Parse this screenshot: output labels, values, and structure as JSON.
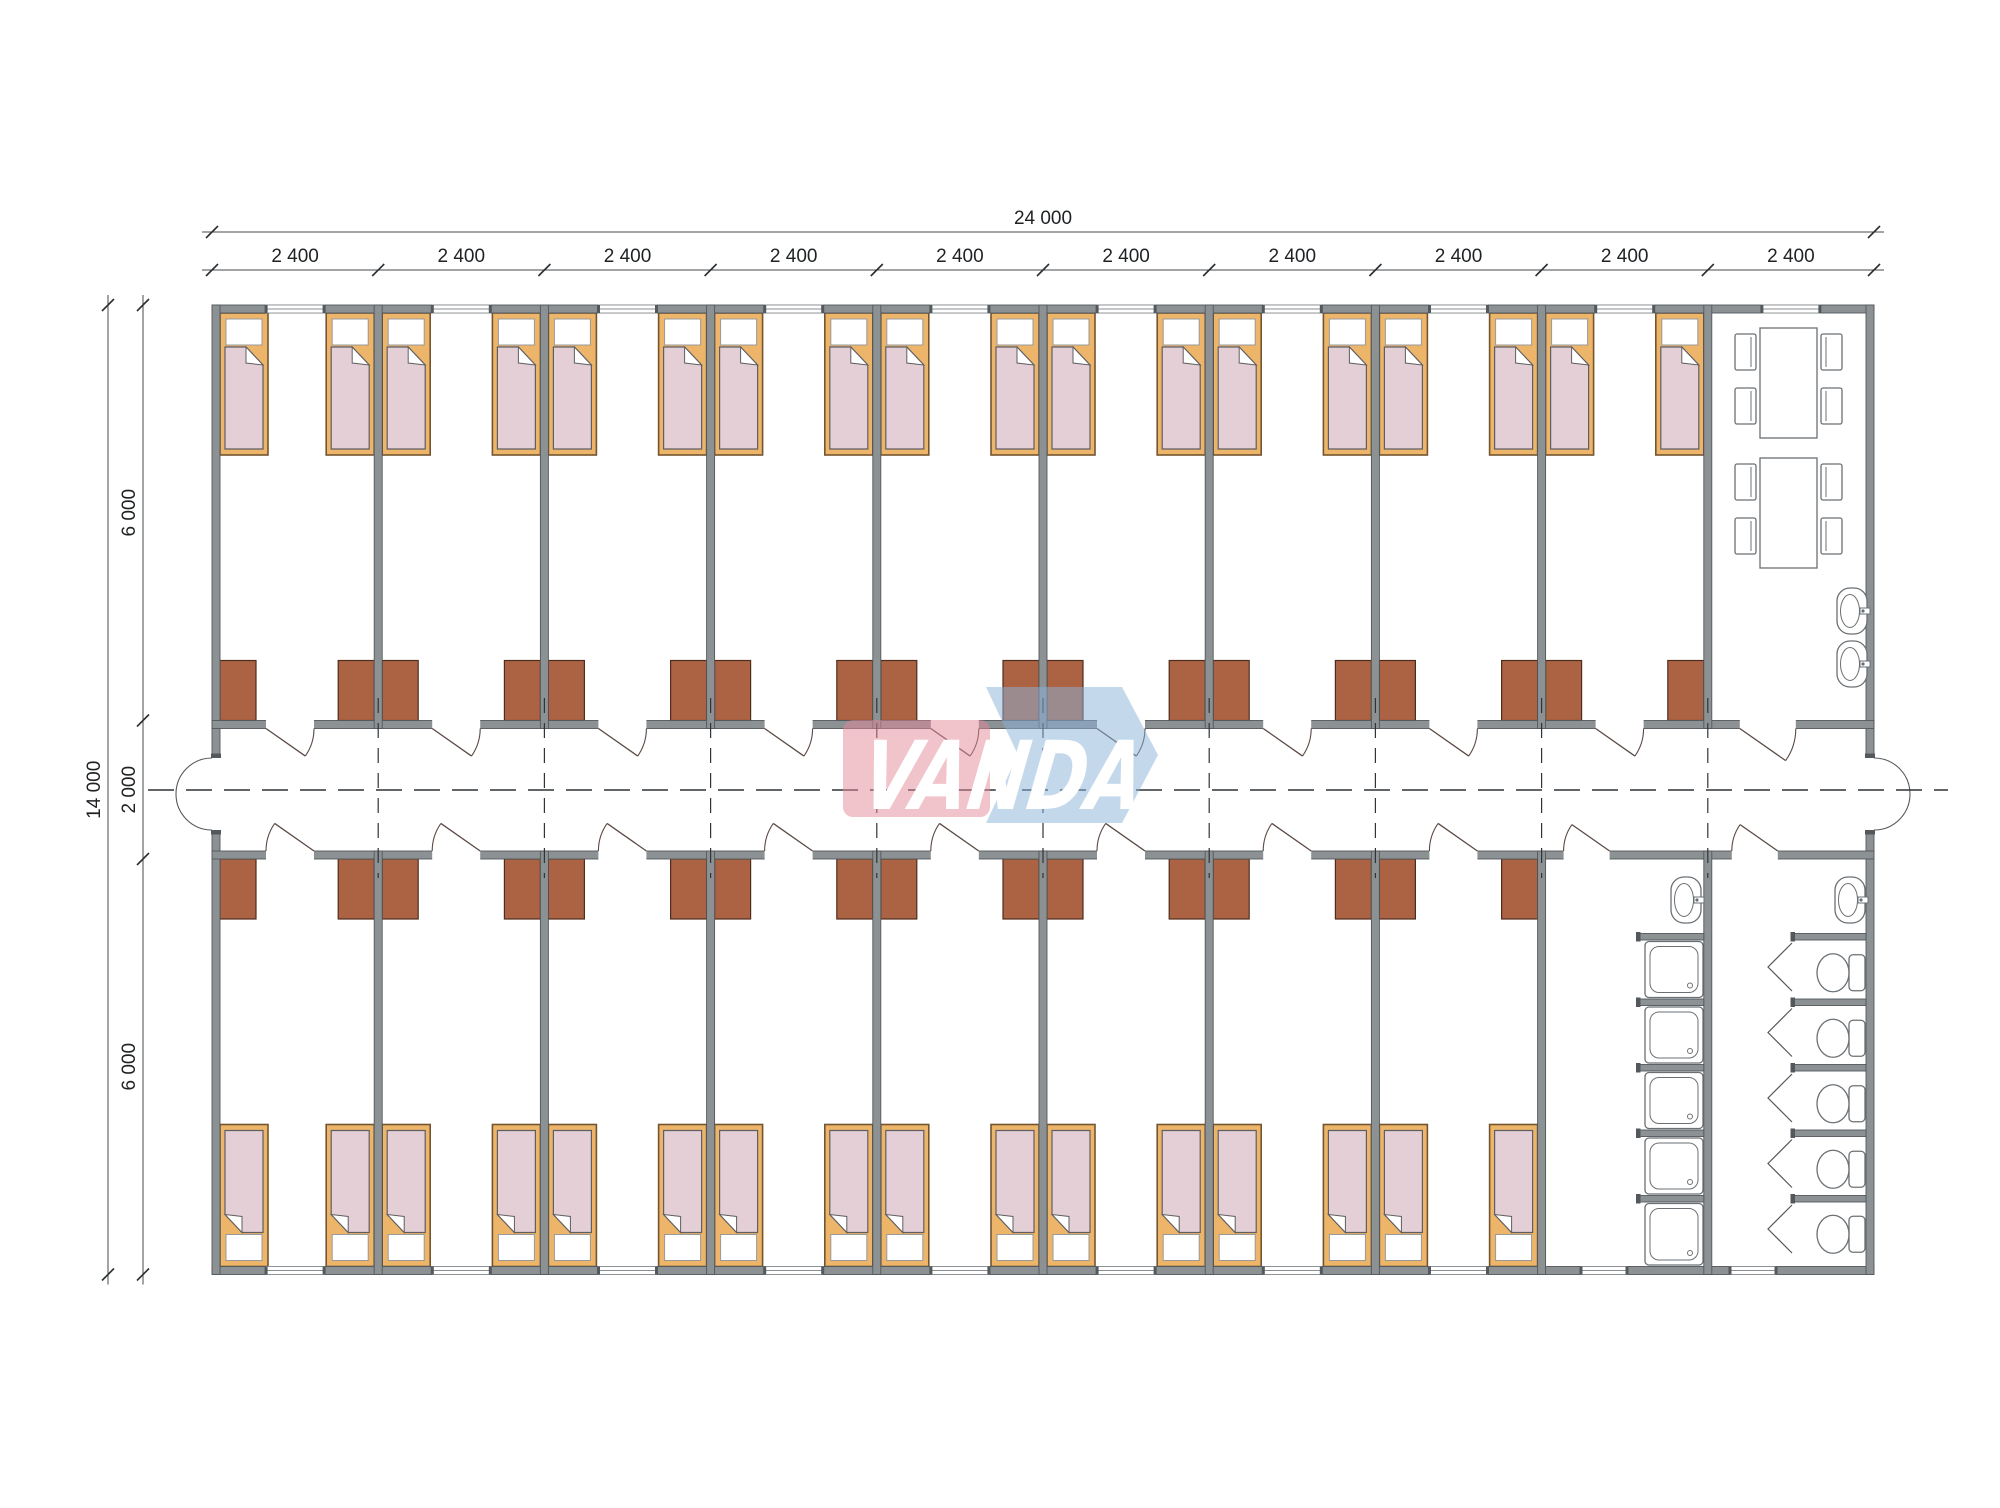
{
  "title": "VANDA modular dormitory floor plan",
  "dimensions": {
    "total_width_label": "24 000",
    "module_label": "2 400",
    "module_count": 10,
    "total_height_label": "14 000",
    "height_segments": [
      "6 000",
      "2 000",
      "6 000"
    ]
  },
  "logo": {
    "text": "VANDA",
    "pink": "#E48797",
    "blue": "#89B1D9"
  },
  "colors": {
    "wall": "#8C9194",
    "wall_outline": "#53585C",
    "bed_frame": "#ECB56A",
    "bed_frame_outline": "#75552F",
    "mattress": "#E3CFD5",
    "mattress_outline": "#5F5F63",
    "pillow": "#FFFFFF",
    "pillow_outline": "#999999",
    "wardrobe": "#AC6343",
    "wardrobe_outline": "#4F2D1E",
    "fixture": "#6B7074",
    "line": "#2F3437",
    "window_line": "#8A8F93"
  },
  "rooms": {
    "top_bedrooms": 9,
    "bottom_bedrooms": 8,
    "beds_per_room": 2,
    "wardrobes_per_room": 2,
    "dining": {
      "tables": 2,
      "chairs_per_table": 4,
      "washbasins": 2
    },
    "shower_room": {
      "showers": 5,
      "washbasins": 1
    },
    "toilet_room": {
      "toilets": 5,
      "washbasins": 1
    },
    "entrance_double_doors": 2,
    "windows": 20
  }
}
